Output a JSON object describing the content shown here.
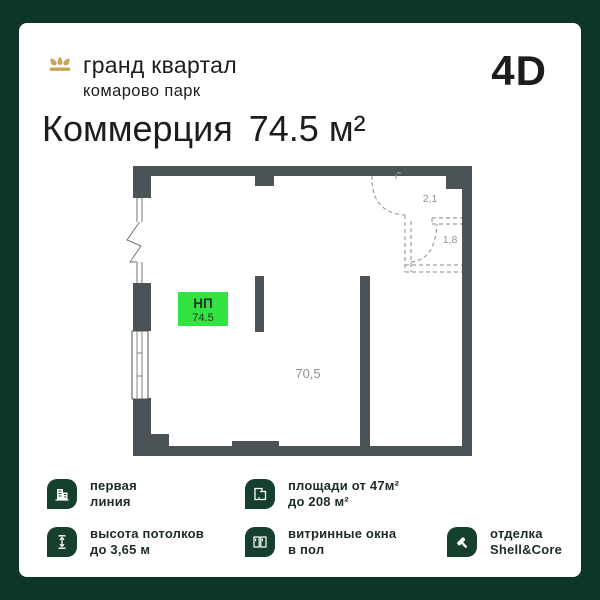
{
  "theme": {
    "border-green": "#0e352a",
    "card-bg": "#ffffff",
    "wall": "#4c5356",
    "accent-green": "#33e341",
    "gold": "#c7a254",
    "ink": "#1d1d1b",
    "muted": "#8d9496",
    "dash": "#9aa0a2",
    "tile-green": "#15402d",
    "feature-ink": "#1b2d25"
  },
  "header": {
    "brand_name": "гранд квартал",
    "brand_subtitle": "комарово парк",
    "format_badge": "4D"
  },
  "title": {
    "category": "Коммерция",
    "area": "74.5 м²"
  },
  "floorplan": {
    "unit_label": "НП",
    "unit_area": "74.5",
    "main_room_area": "70,5",
    "small_room_1": "2,1",
    "small_room_2": "1,8"
  },
  "features": [
    {
      "icon": "building-icon",
      "line1": "первая",
      "line2": "линия"
    },
    {
      "icon": "area-range-icon",
      "line1": "площади от 47м²",
      "line2": "до 208 м²"
    },
    {
      "icon": "ceiling-height-icon",
      "line1": "высота потолков",
      "line2": "до 3,65 м"
    },
    {
      "icon": "storefront-window-icon",
      "line1": "витринные окна",
      "line2": "в пол"
    },
    {
      "icon": "paint-roller-icon",
      "line1": "отделка",
      "line2": "Shell&Core"
    }
  ]
}
